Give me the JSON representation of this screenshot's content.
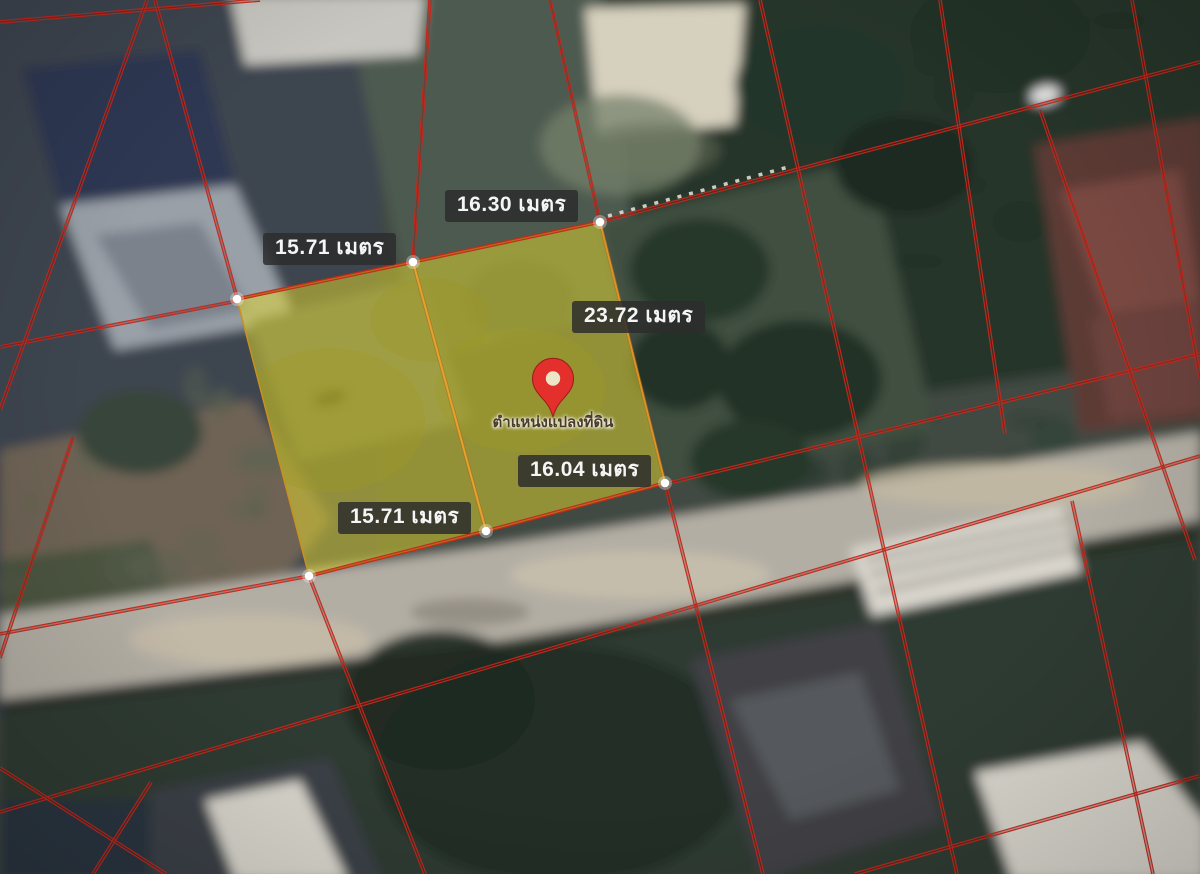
{
  "map": {
    "type": "satellite-cadastral-parcel-map",
    "pin": {
      "label": "ตำแหน่งแปลงที่ดิน"
    },
    "labels": {
      "top": "16.30 เมตร",
      "upper_left": "15.71 เมตร",
      "right": "23.72 เมตร",
      "bottom": "16.04 เมตร",
      "lower_left": "15.71 เมตร"
    },
    "measurements": [
      {
        "side": "north-west",
        "length_m": 15.71,
        "unit": "เมตร"
      },
      {
        "side": "north",
        "length_m": 16.3,
        "unit": "เมตร"
      },
      {
        "side": "east",
        "length_m": 23.72,
        "unit": "เมตร"
      },
      {
        "side": "south",
        "length_m": 16.04,
        "unit": "เมตร"
      },
      {
        "side": "south-west",
        "length_m": 15.71,
        "unit": "เมตร"
      }
    ],
    "colors": {
      "parcel_highlight": "#e6d92b",
      "cadastral_line": "#c9281b",
      "divider_line": "#dd9426",
      "pin": "#e3302c",
      "label_bg": "rgba(45,45,45,0.85)",
      "label_text": "#f5f5f5"
    }
  }
}
